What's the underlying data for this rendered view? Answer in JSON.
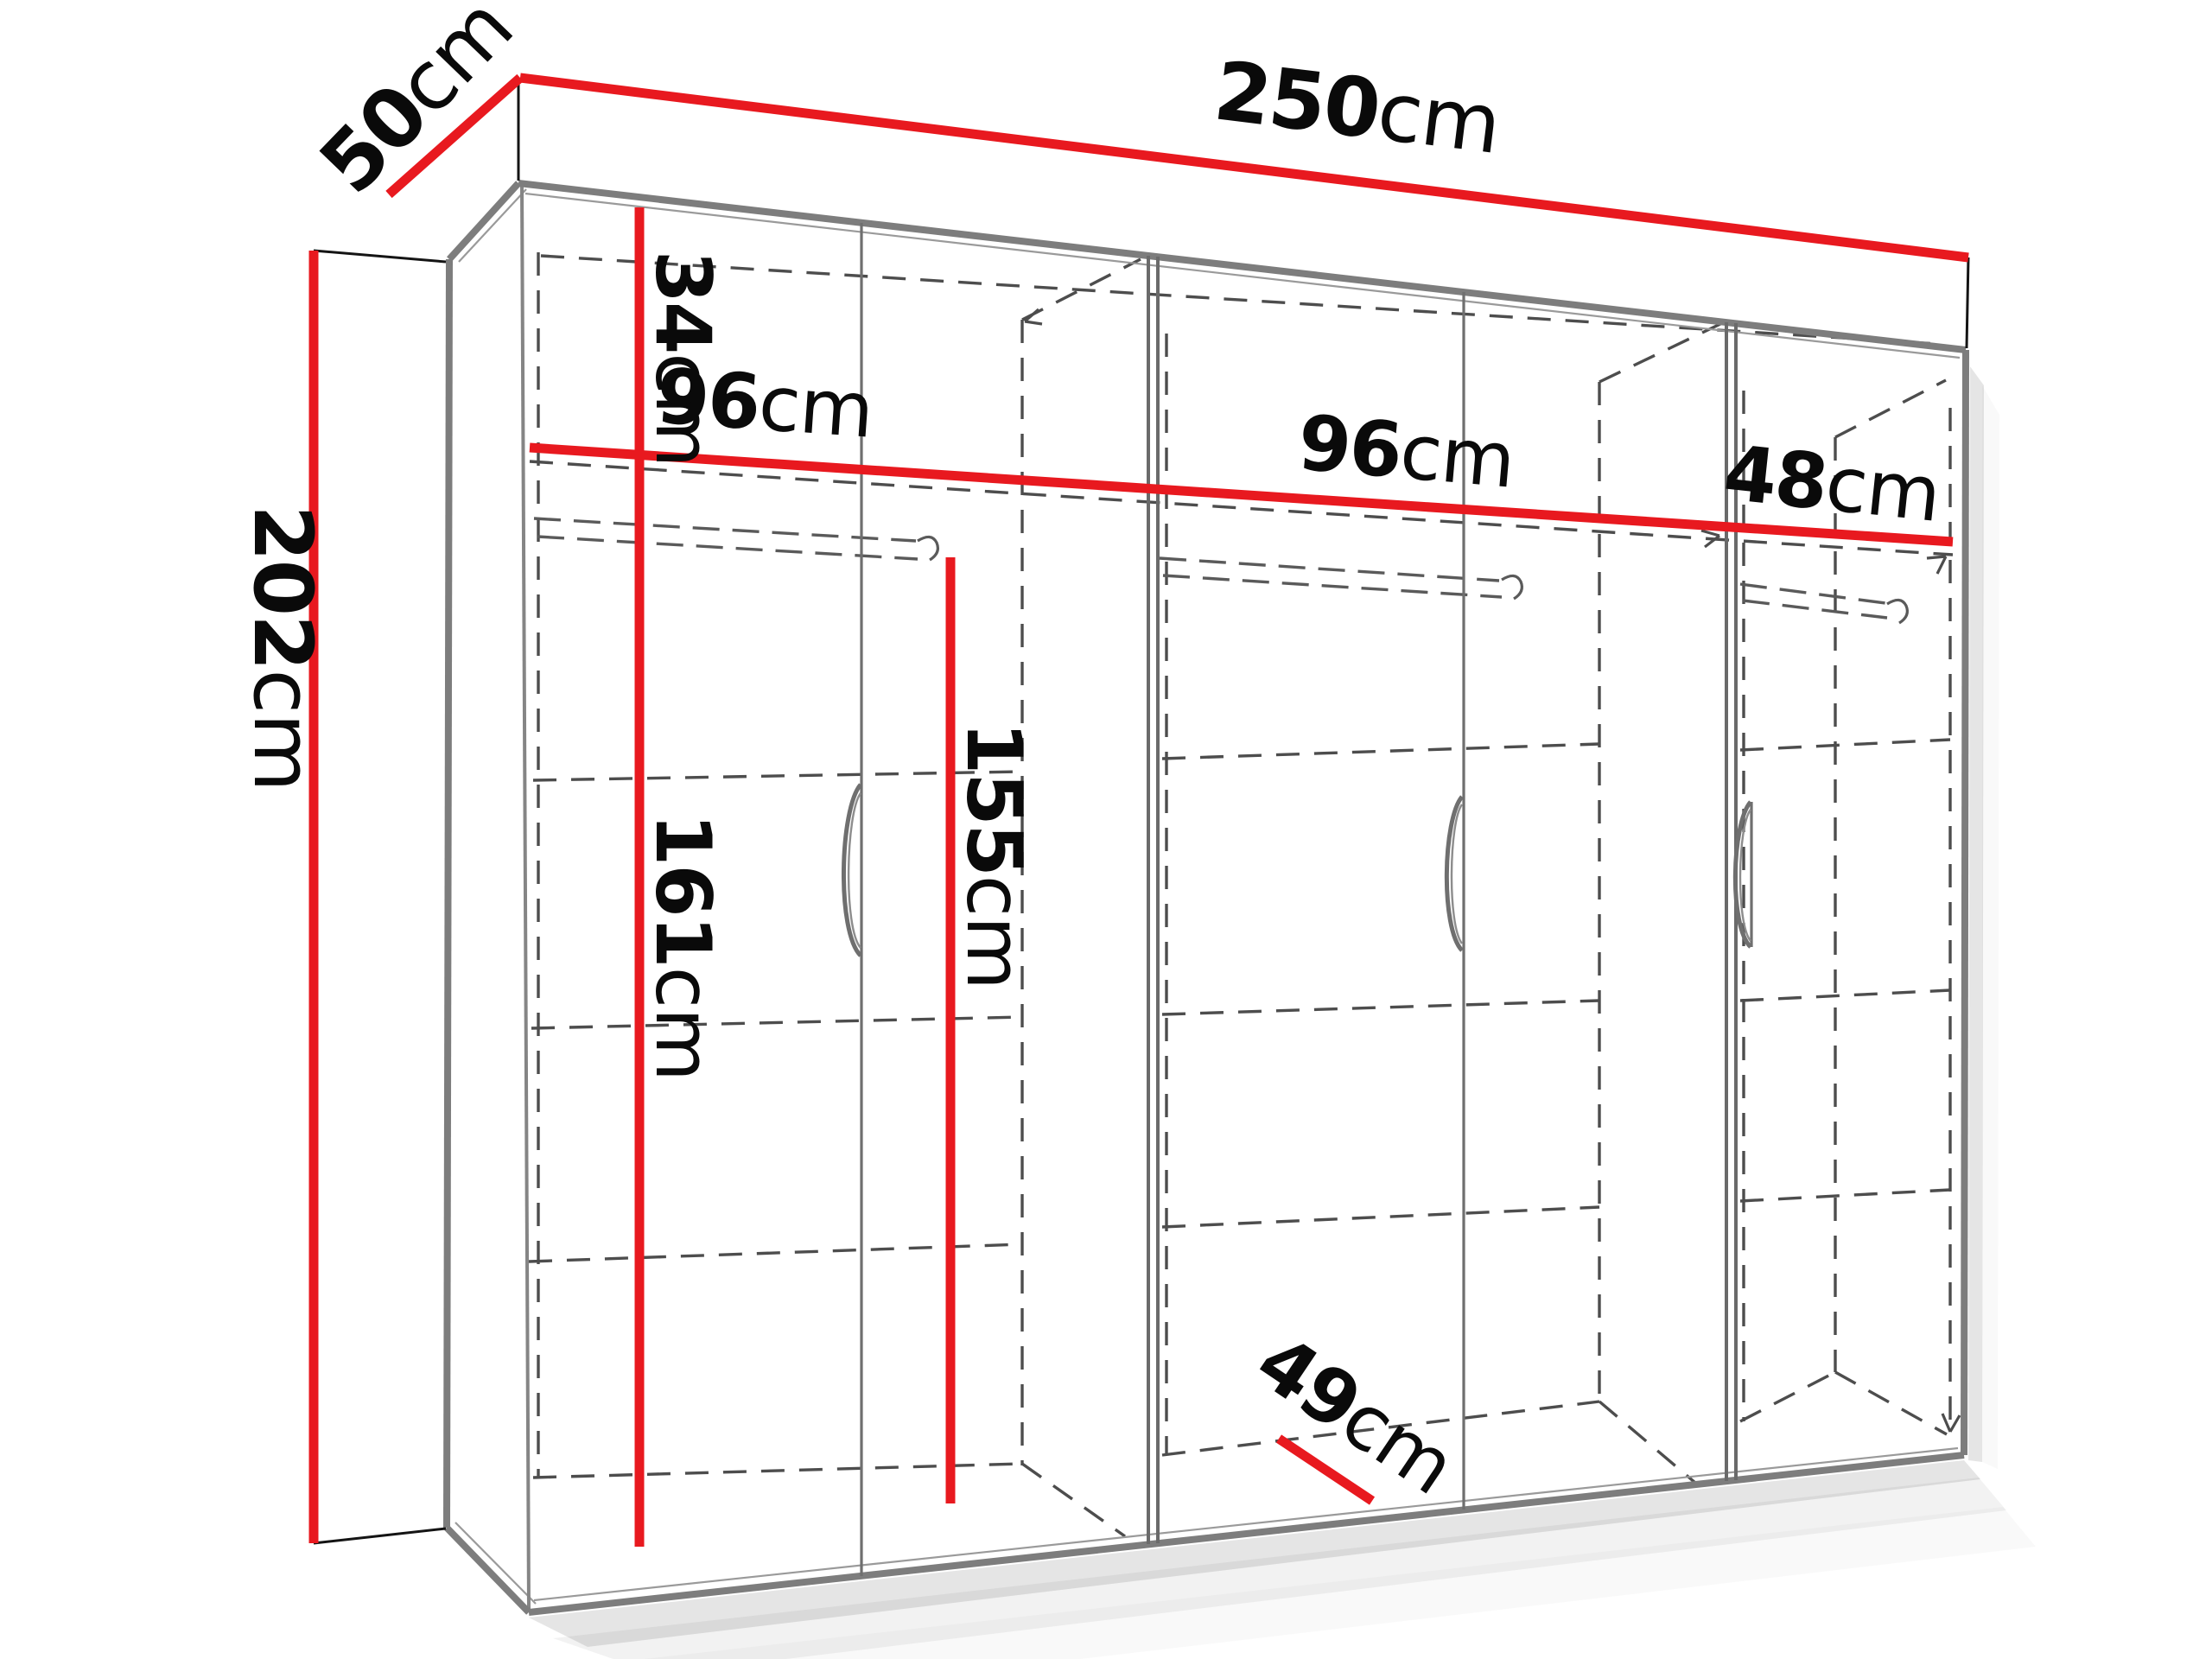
{
  "figure": {
    "kind": "wardrobe-dimension-diagram",
    "unit": "cm",
    "colors": {
      "dimension_line": "#e8191f",
      "frame": "#7d7d7d",
      "hidden_line": "#4d4d4d",
      "label_text": "#0a0a0a",
      "background": "#ffffff"
    },
    "dimensions": {
      "width": {
        "value": "250",
        "unit": "cm"
      },
      "depth": {
        "value": "50",
        "unit": "cm"
      },
      "height": {
        "value": "202",
        "unit": "cm"
      },
      "top_shelf": {
        "value": "34",
        "unit": "cm"
      },
      "left_section": {
        "value": "96",
        "unit": "cm"
      },
      "middle_section": {
        "value": "96",
        "unit": "cm"
      },
      "right_section": {
        "value": "48",
        "unit": "cm"
      },
      "hanging_space": {
        "value": "155",
        "unit": "cm"
      },
      "interior_height": {
        "value": "161",
        "unit": "cm"
      },
      "interior_depth": {
        "value": "49",
        "unit": "cm"
      }
    }
  }
}
